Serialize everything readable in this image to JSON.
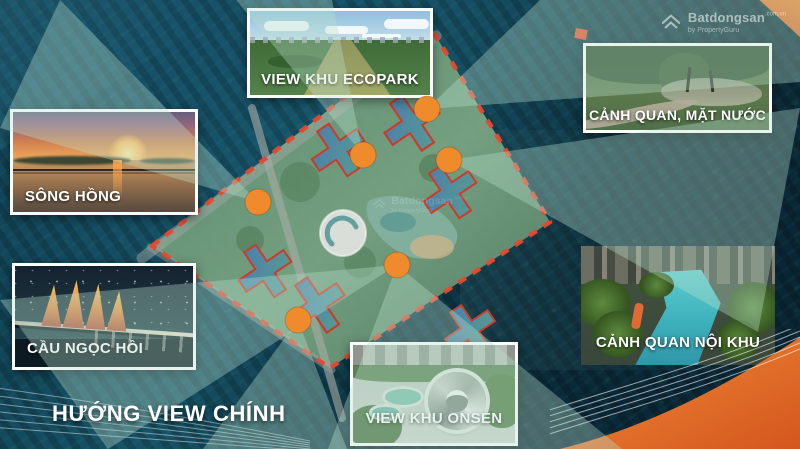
{
  "title": "HƯỚNG VIEW CHÍNH",
  "watermark": {
    "brand": "Batdongsan",
    "domain_suffix": ".com.vn",
    "byline": "by PropertyGuru",
    "icon": "batdongsan-house-icon"
  },
  "callouts": {
    "ecopark": {
      "label": "VIEW KHU ECOPARK"
    },
    "song_hong": {
      "label": "SÔNG HỒNG"
    },
    "mat_nuoc": {
      "label": "CẢNH QUAN, MẶT NƯỚC"
    },
    "cau_ngoc_hoi": {
      "label": "CẦU NGỌC HỒI"
    },
    "noi_khu": {
      "label": "CẢNH QUAN NỘI KHU"
    },
    "onsen": {
      "label": "VIEW KHU ONSEN"
    }
  },
  "diagram": {
    "view_marker_icon": "orange-view-point-marker",
    "boundary_style": "red-dashed-site-boundary",
    "beam_style": "teal-view-direction-beam"
  },
  "colors": {
    "accent_orange": "#EF8A2D",
    "boundary_red": "#E6492E",
    "beam_teal": "#BBE0CD",
    "label_white": "#FFFFFF",
    "background_navy": "#0D3140"
  }
}
